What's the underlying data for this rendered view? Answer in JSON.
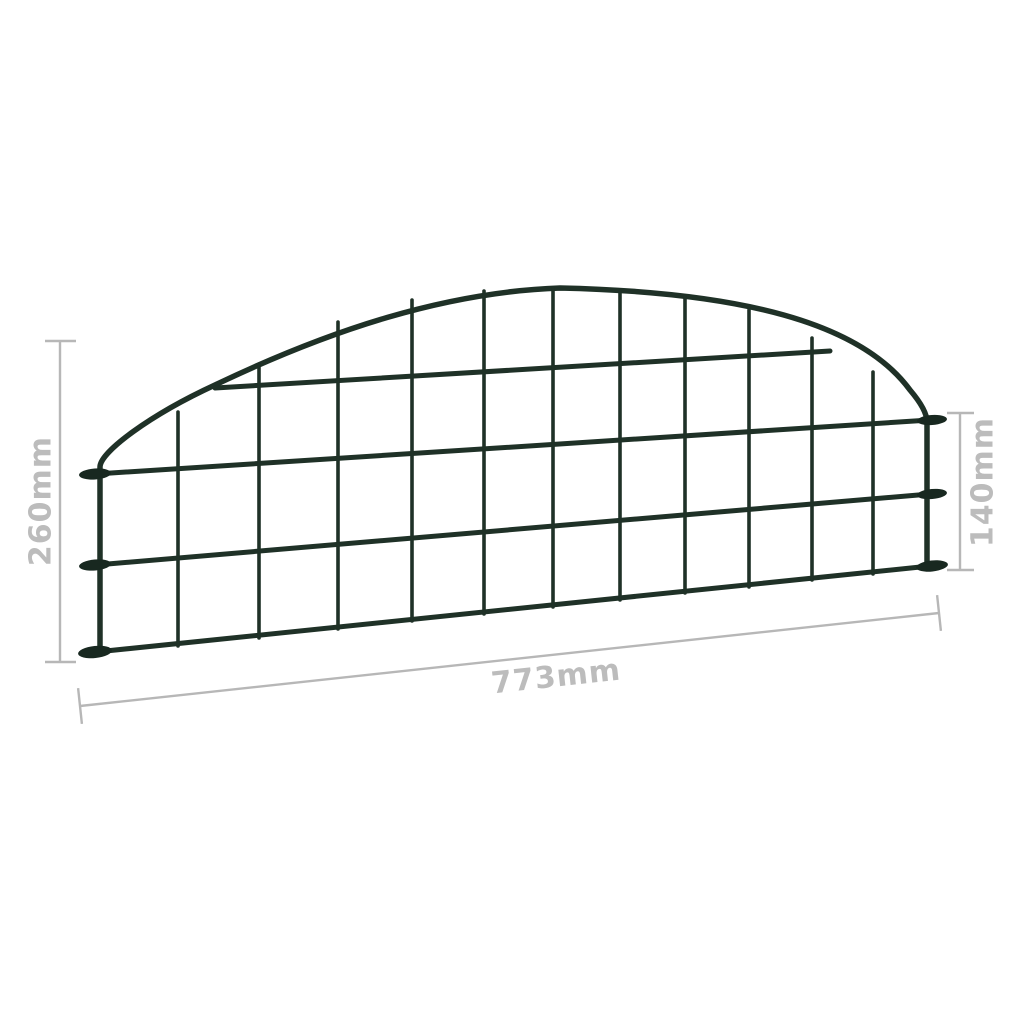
{
  "colors": {
    "wire": "#1f3127",
    "foot": "#182820",
    "dimension_line": "#b7b7b7",
    "dimension_text": "#bcbcbc",
    "background": "#ffffff"
  },
  "dimensions": {
    "left_height": {
      "label": "260mm"
    },
    "right_height": {
      "label": "140mm"
    },
    "bottom_width": {
      "label": "773mm"
    }
  }
}
